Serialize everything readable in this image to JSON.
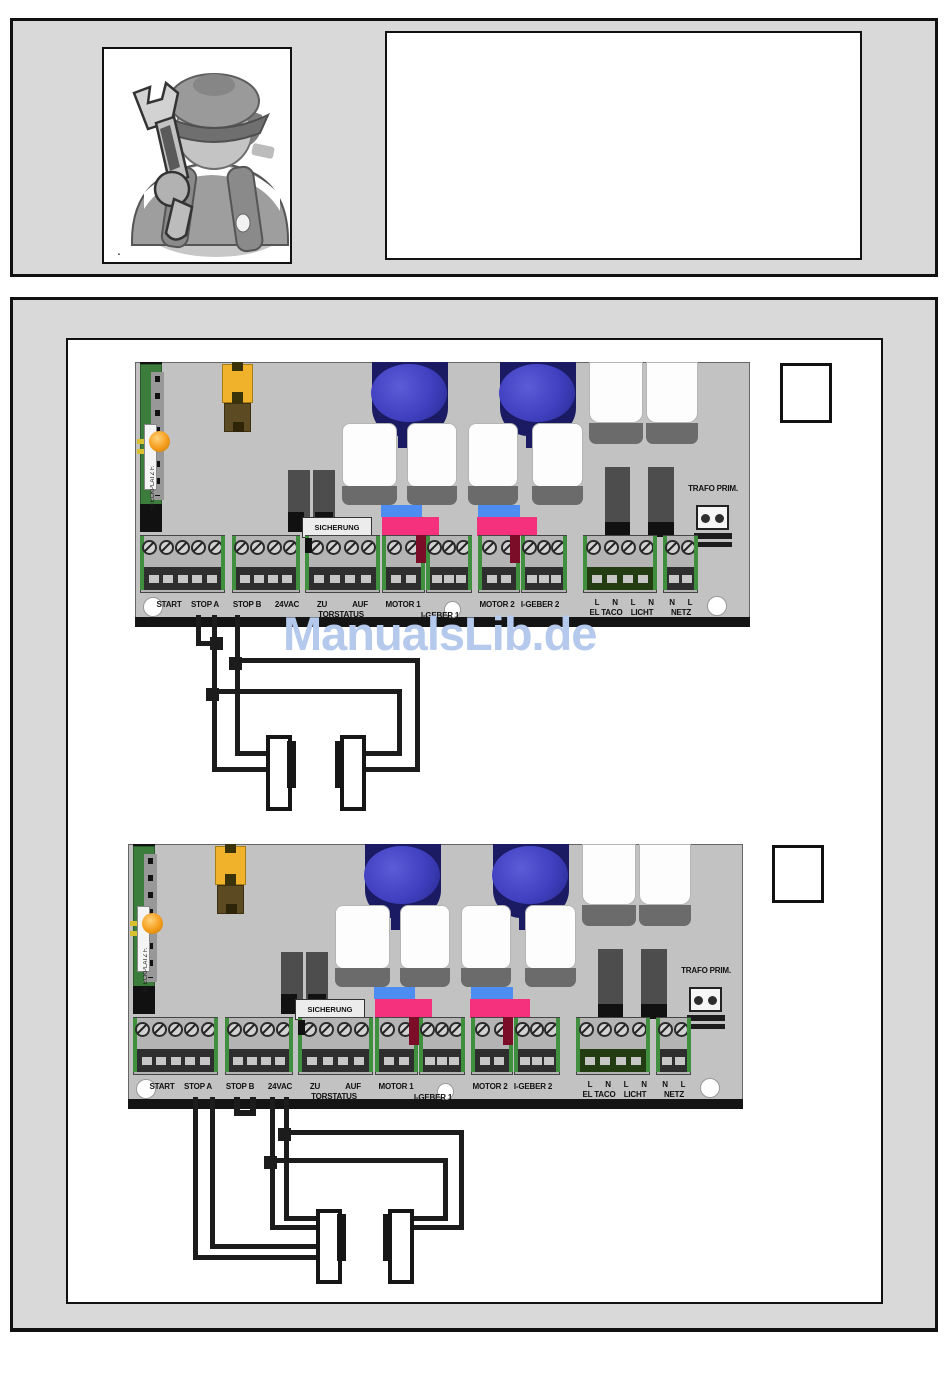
{
  "top": {
    "icon_caption": "."
  },
  "watermark": {
    "text": "ManualsLib.de",
    "color": "#b5c9ed"
  },
  "board": {
    "labels": {
      "start": "START",
      "stop_a": "STOP A",
      "stop_b": "STOP B",
      "vac24": "24VAC",
      "zu": "ZU",
      "auf": "AUF",
      "torstatus": "TORSTATUS",
      "motor1": "MOTOR 1",
      "igeber1": "I-GEBER 1",
      "motor2": "MOTOR 2",
      "igeber2": "I-GEBER 2",
      "pin_l": "L",
      "pin_n": "N",
      "el_taco": "EL TACO",
      "licht": "LICHT",
      "netz": "NETZ",
      "sicherung": "SICHERUNG",
      "trafo_prim": "TRAFO PRIM.",
      "steckplatz": "STECKPLATZ F."
    }
  },
  "colors": {
    "box_gray": "#d9d9d9",
    "board_gray": "#c2c2c2",
    "pcb_green": "#3c7c3c",
    "cap_navy": "#1b1b63",
    "cap_blue": "#4040c0",
    "connector_blue": "#4d8cf0",
    "connector_pink": "#f5307d",
    "fuse_yellow": "#f0b22a",
    "fuse_brown": "#5c4a22",
    "led_orange": "#f59c1a",
    "wire_black": "#1c1c1c",
    "watermark_blue": "#b5c9ed"
  }
}
